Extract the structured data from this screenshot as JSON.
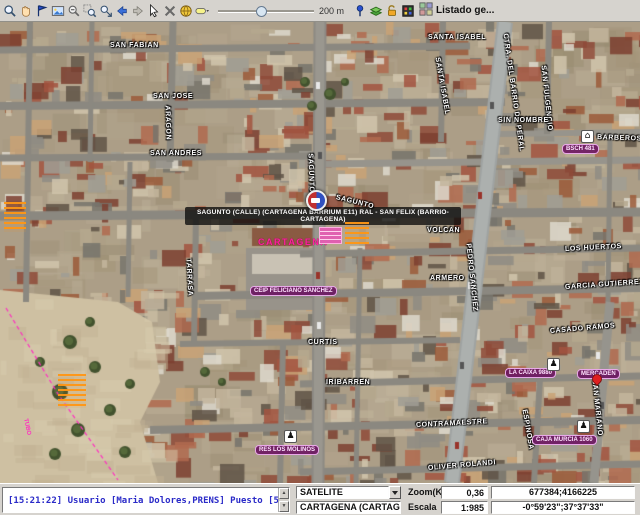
{
  "toolbar": {
    "icons": [
      "zoom-in-icon",
      "pan-icon",
      "flag-icon",
      "image-icon",
      "zoom-out-icon",
      "zoom-window-icon",
      "zoom-select-icon",
      "back-arrow-icon",
      "forward-arrow-icon",
      "pointer-icon",
      "delete-icon",
      "globe-icon",
      "marker-style-icon"
    ],
    "icons_right": [
      "pushpin-icon",
      "layers-icon",
      "unlock-icon",
      "legend-icon"
    ],
    "scale_label": "200 m",
    "listado_label": "Listado ge..."
  },
  "map": {
    "unit_label": "SAGUNTO (CALLE) (CARTAGENA BARRIUM E11) RAL - SAN FELIX (BARRIO-CARTAGENA)",
    "city_label": "CARTAGENA",
    "street_labels": [
      {
        "text": "SAN FABIAN",
        "x": 110,
        "y": 20,
        "rot": 0
      },
      {
        "text": "SAN JOSE",
        "x": 153,
        "y": 71,
        "rot": 0
      },
      {
        "text": "ARAGON",
        "x": 167,
        "y": 80,
        "rot": 88
      },
      {
        "text": "SAN ANDRES",
        "x": 150,
        "y": 128,
        "rot": 0
      },
      {
        "text": "SANTA ISABEL",
        "x": 428,
        "y": 12,
        "rot": 0
      },
      {
        "text": "SANTA ISABEL",
        "x": 437,
        "y": 32,
        "rot": 80
      },
      {
        "text": "CTRA. DEL BARRIO DE PERAL",
        "x": 505,
        "y": 8,
        "rot": 82
      },
      {
        "text": "SAN FULGENCIO",
        "x": 543,
        "y": 40,
        "rot": 84
      },
      {
        "text": "SIN NOMBRE",
        "x": 498,
        "y": 95,
        "rot": 0
      },
      {
        "text": "BARBEROS",
        "x": 597,
        "y": 112,
        "rot": 2
      },
      {
        "text": "SAGUNTO",
        "x": 310,
        "y": 128,
        "rot": 88
      },
      {
        "text": "SAGUNTO",
        "x": 336,
        "y": 172,
        "rot": 14
      },
      {
        "text": "VOLCAN",
        "x": 427,
        "y": 205,
        "rot": 0
      },
      {
        "text": "LOS HUERTOS",
        "x": 565,
        "y": 224,
        "rot": -3
      },
      {
        "text": "PEDRO SANCHEZ",
        "x": 468,
        "y": 218,
        "rot": 84
      },
      {
        "text": "ARMERO",
        "x": 430,
        "y": 253,
        "rot": 0
      },
      {
        "text": "GARCIA GUTIERREZ",
        "x": 565,
        "y": 262,
        "rot": -4
      },
      {
        "text": "TARRASA",
        "x": 188,
        "y": 233,
        "rot": 87
      },
      {
        "text": "CASADO RAMOS",
        "x": 550,
        "y": 306,
        "rot": -5
      },
      {
        "text": "CURTIS",
        "x": 308,
        "y": 317,
        "rot": 0
      },
      {
        "text": "IRIBARREN",
        "x": 326,
        "y": 357,
        "rot": 0
      },
      {
        "text": "CONTRAMAESTRE",
        "x": 416,
        "y": 400,
        "rot": -3
      },
      {
        "text": "ESPINOSA",
        "x": 524,
        "y": 384,
        "rot": 80
      },
      {
        "text": "SAN MARIANO",
        "x": 594,
        "y": 354,
        "rot": 84
      },
      {
        "text": "OLIVER ROLANDI",
        "x": 428,
        "y": 443,
        "rot": -5
      }
    ],
    "poi_labels": [
      {
        "text": "BSCH 481",
        "x": 562,
        "y": 122
      },
      {
        "text": "CEIP FELICIANO SANCHEZ",
        "x": 250,
        "y": 264
      },
      {
        "text": "RES LOS MOLINOS",
        "x": 255,
        "y": 423
      },
      {
        "text": "LA CAIXA 9880",
        "x": 505,
        "y": 346
      },
      {
        "text": "MERCADEN",
        "x": 577,
        "y": 347
      },
      {
        "text": "CAJA MURCIA 1060",
        "x": 532,
        "y": 413
      }
    ],
    "poi_icons": [
      {
        "name": "bank-icon",
        "x": 581,
        "y": 108
      },
      {
        "name": "person-icon",
        "x": 547,
        "y": 336
      },
      {
        "name": "person-icon",
        "x": 577,
        "y": 398
      },
      {
        "name": "person-icon",
        "x": 284,
        "y": 408
      },
      {
        "name": "pin-icon",
        "x": 592,
        "y": 352
      },
      {
        "name": "unit-marker-icon",
        "x": 306,
        "y": 168
      }
    ],
    "tiny_blocks": [
      {
        "kind": "orange",
        "x": 4,
        "y": 180,
        "w": 22,
        "h": 30
      },
      {
        "kind": "orange",
        "x": 58,
        "y": 352,
        "w": 28,
        "h": 34
      },
      {
        "kind": "orange",
        "x": 345,
        "y": 200,
        "w": 24,
        "h": 22
      },
      {
        "kind": "pink",
        "x": 319,
        "y": 205,
        "w": 21,
        "h": 15
      }
    ],
    "tiny_texts": [
      {
        "text": "TUBO",
        "x": 28,
        "y": 396,
        "rot": 78,
        "color": "#ff30c0"
      }
    ]
  },
  "statusbar": {
    "log": "[15:21:22] Usuario [Maria Dolores,PRENS] Puesto [50]",
    "layer_select": "SATELITE",
    "zoom_label": "Zoom(Km)",
    "zoom_value": "0,36",
    "coords_utm": "677384;4166225",
    "municipality": "CARTAGENA (CARTAGENA)",
    "scale_label": "Escala",
    "scale_value": "1:985",
    "coords_geo": "-0°59'23\";37°37'33\""
  },
  "colors": {
    "toolbar_bg": "#d6d3ce",
    "log_text_blue": "#2a2ac8",
    "poi_purple": "#6a1260",
    "city_pink": "#ff20a0",
    "dashed_line_magenta": "#ff30c0"
  }
}
